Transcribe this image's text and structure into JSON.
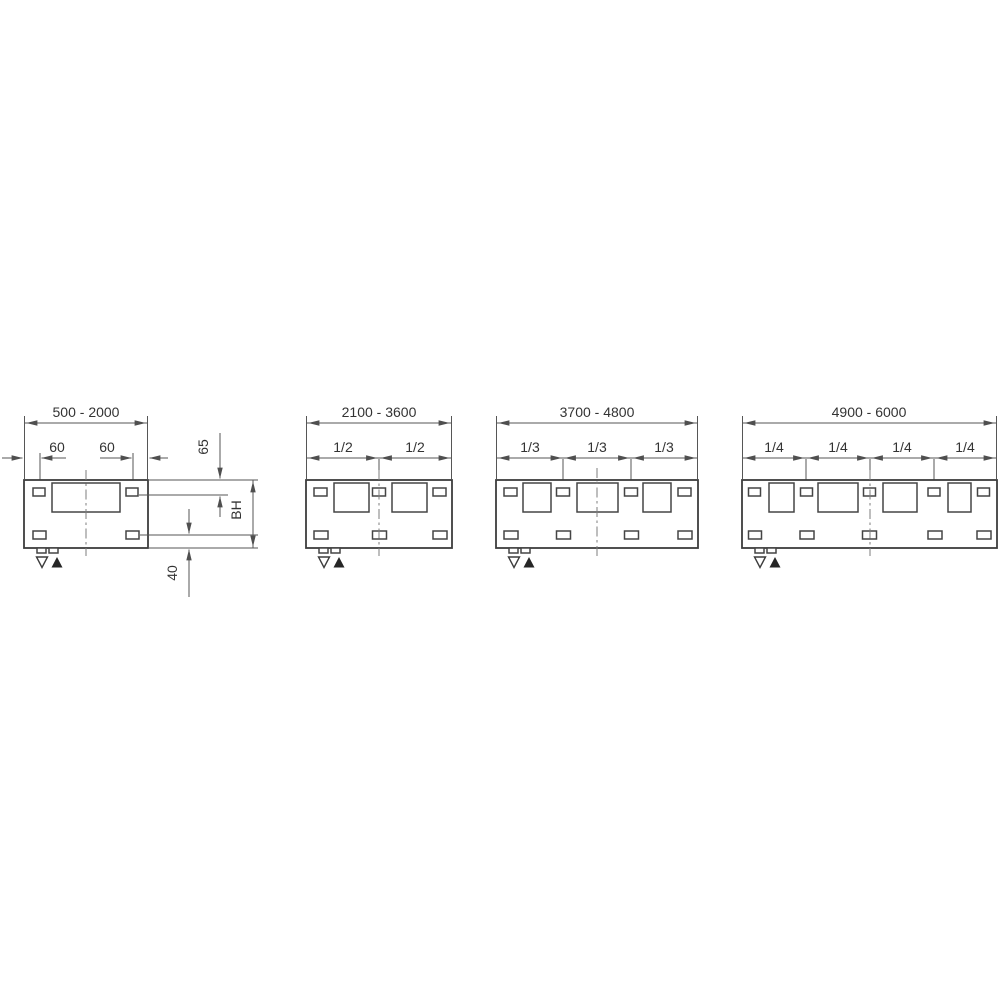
{
  "drawing": {
    "background": "#ffffff",
    "line_color": "#4f4f4f",
    "text_color": "#333333",
    "icons": {
      "level_min": "open-triangle-down",
      "level_max": "filled-triangle-up"
    }
  },
  "panels": [
    {
      "name": "width-range-1",
      "range_label": "500 - 2000",
      "top_dims": [
        "60",
        "60"
      ],
      "side_dims": {
        "top_slot_offset": "65",
        "body_height": "BH",
        "bottom_slot_offset": "40"
      }
    },
    {
      "name": "width-range-2",
      "range_label": "2100 - 3600",
      "top_dims": [
        "1/2",
        "1/2"
      ]
    },
    {
      "name": "width-range-3",
      "range_label": "3700 - 4800",
      "top_dims": [
        "1/3",
        "1/3",
        "1/3"
      ]
    },
    {
      "name": "width-range-4",
      "range_label": "4900 - 6000",
      "top_dims": [
        "1/4",
        "1/4",
        "1/4",
        "1/4"
      ]
    }
  ]
}
